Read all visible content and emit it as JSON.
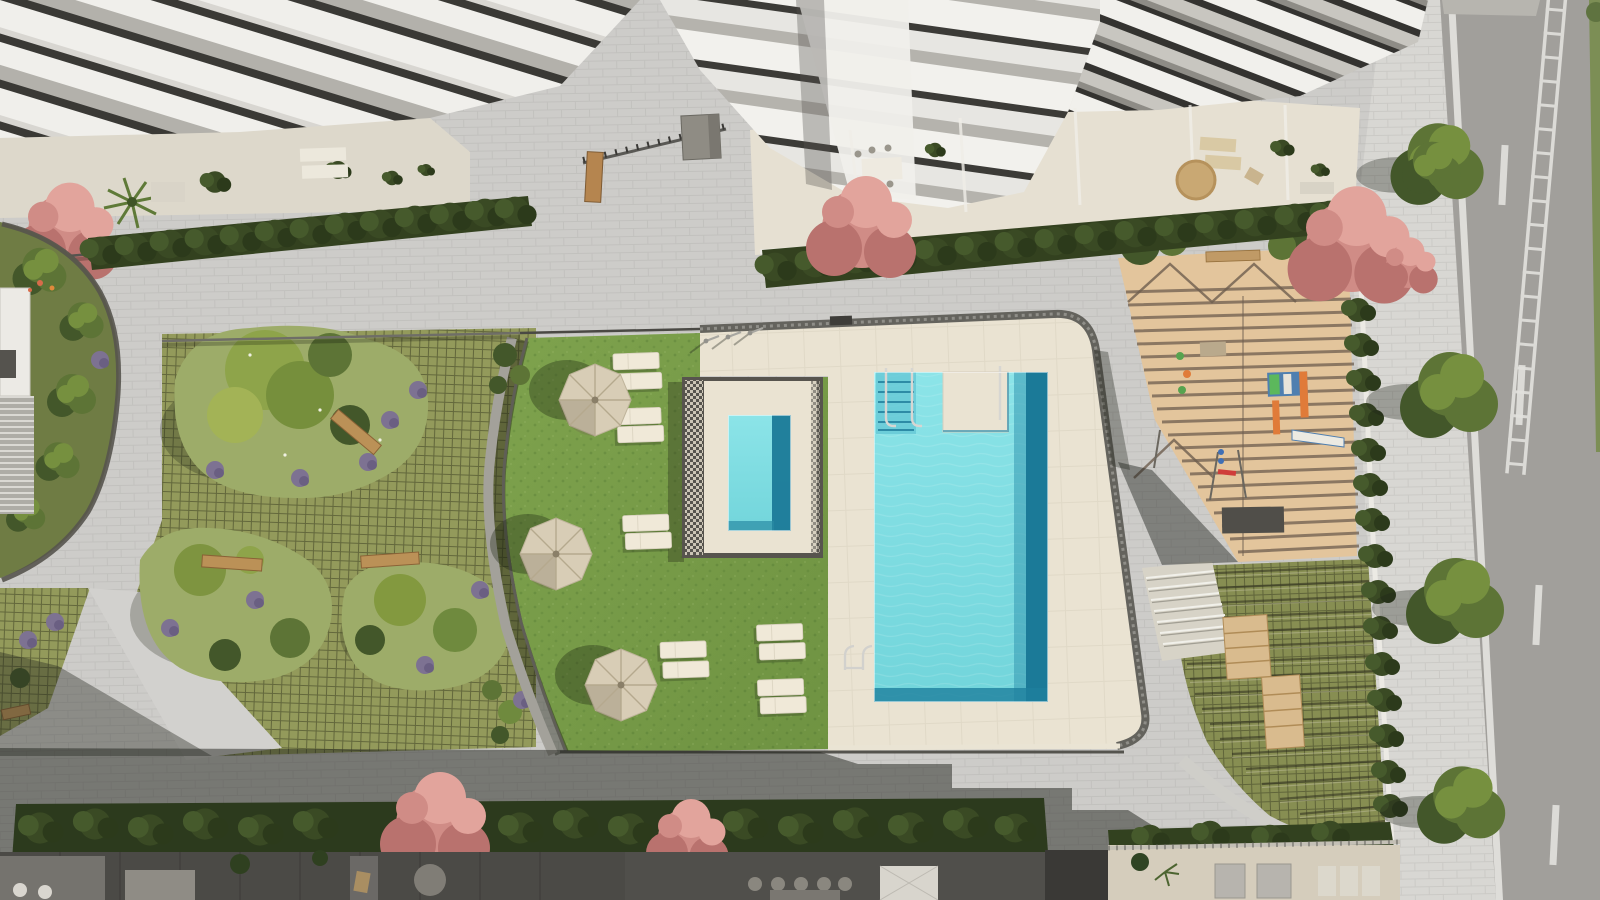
{
  "scene": {
    "type": "aerial-architectural-render",
    "width": 1600,
    "height": 900,
    "description": "Top-down rendering of a residential complex courtyard: main swimming pool and raised kids pool on a cream deck, bright lawn with parasols and sun loungers, grass-grid gardens with planting islands and benches, sand playground under a pergola, tiered garden, surrounding white apartment buildings with balconies, hedges, pink flowering trees, a paved sidewalk with trees and an asphalt road with lane markings"
  },
  "palette": {
    "pavement": "#cdccc9",
    "pavementLight": "#d8d7d3",
    "road": "#a19f9b",
    "roadMark": "#e3e2de",
    "deck": "#eae3d2",
    "coping": "#64635d",
    "water": "#7edde2",
    "waterDeep": "#1b7a98",
    "lawn": "#77a049",
    "grassGrid": "#939a5b",
    "sand": "#e3c59c",
    "pergola": "#6e5e4f",
    "hedge": "#2e3c1e",
    "treeDark": "#43572a",
    "treeMid": "#5d7436",
    "treeLight": "#76903f",
    "treeYellow": "#8ea44a",
    "lavender": "#7d7292",
    "pink": "#d08c86",
    "pinkDark": "#b9726e",
    "pinkLight": "#e2a49c",
    "parasol": "#d8cdb6",
    "lounger": "#f0e9d8",
    "wood": "#bb9157",
    "slabWhite": "#f3f2ee",
    "slabShadow": "#383733",
    "slabGray": "#b2b0aa",
    "terrace": "#e6e0d2",
    "terraceDark": "#4b4a46",
    "wall": "#eceae4",
    "shadow": "rgba(33,36,30,0.5)"
  },
  "features": {
    "parasols": 3,
    "lawn_loungers": 12,
    "pools": 2,
    "pool_showers": 3,
    "garden_benches": 3,
    "street_trees": 4,
    "pink_flowering_trees": 6,
    "playground": 1,
    "tiered_garden": 1
  }
}
